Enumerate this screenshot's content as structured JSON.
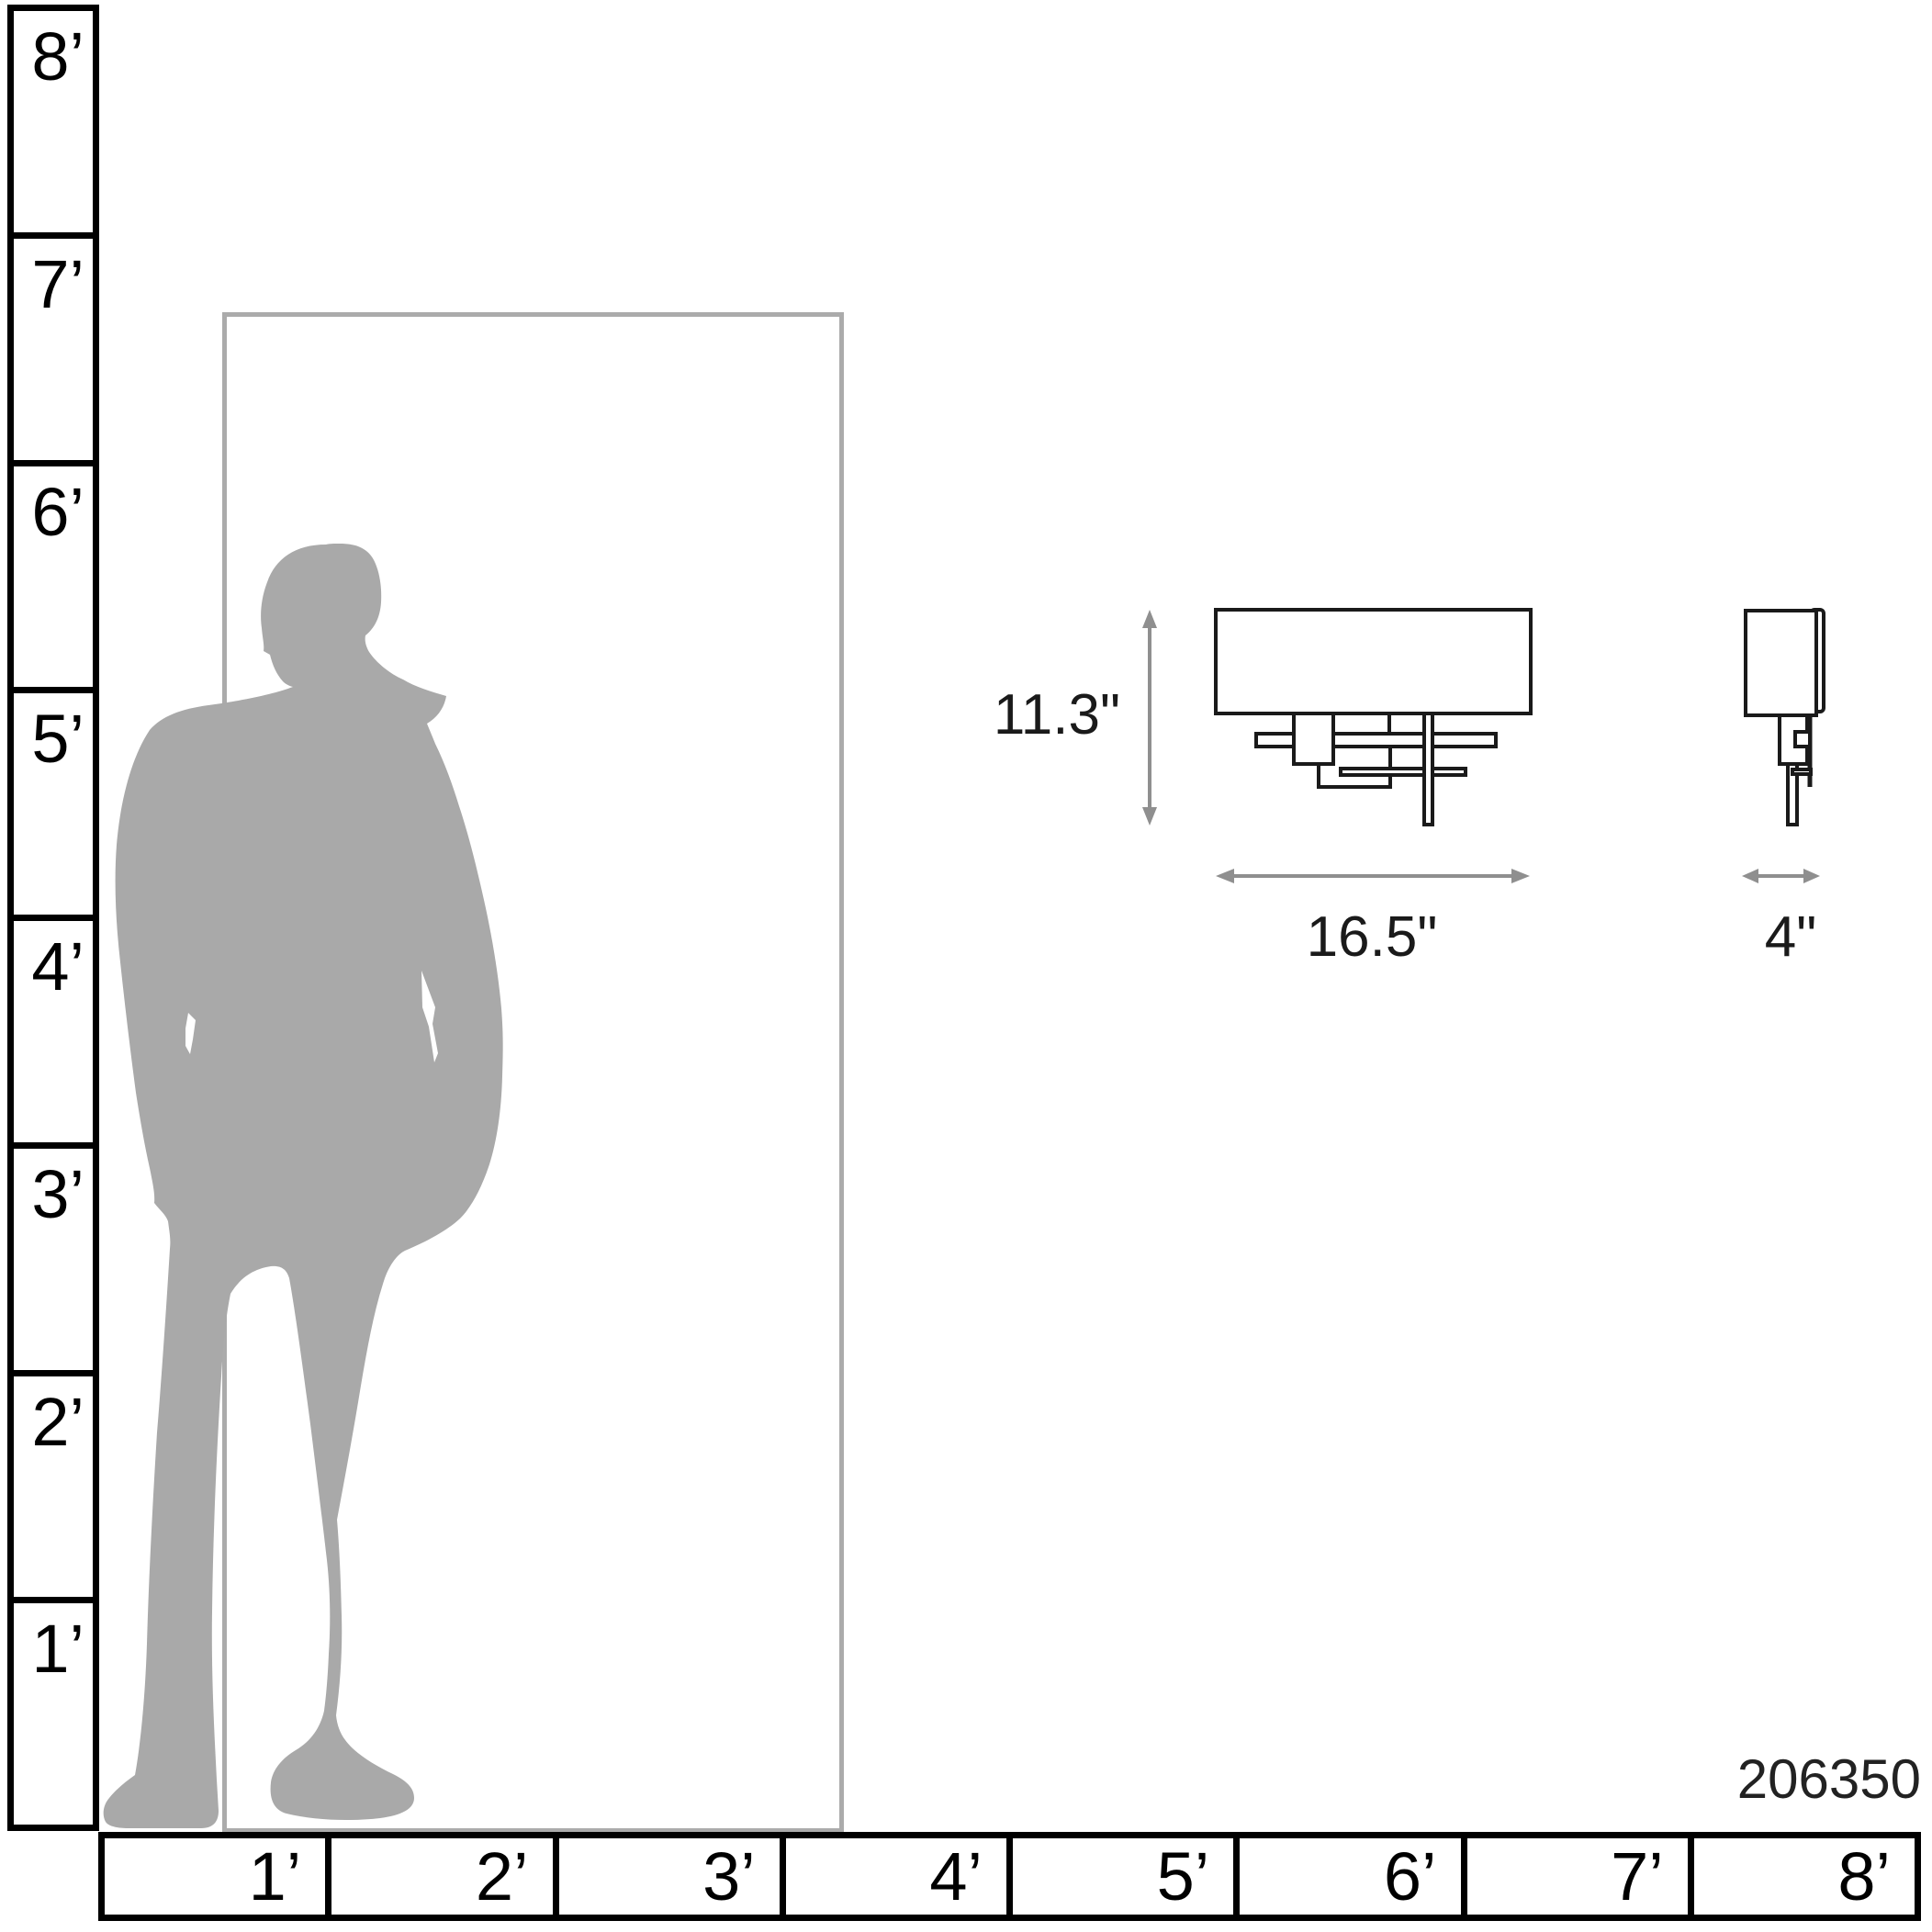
{
  "scale_figure": {
    "product_number": "206350",
    "left_ruler_labels": [
      "8’",
      "7’",
      "6’",
      "5’",
      "4’",
      "3’",
      "2’",
      "1’"
    ],
    "bottom_ruler_labels": [
      "1’",
      "2’",
      "3’",
      "4’",
      "5’",
      "6’",
      "7’",
      "8’"
    ],
    "dimensions": {
      "height": "11.3\"",
      "width": "16.5\"",
      "depth": "4\""
    },
    "colors": {
      "silhouette": "#a9a9a9",
      "door_outline": "#ababab",
      "arrow": "#8f8f8f",
      "ruler_line": "#000000",
      "drawing_line": "#1a1a1a"
    }
  }
}
